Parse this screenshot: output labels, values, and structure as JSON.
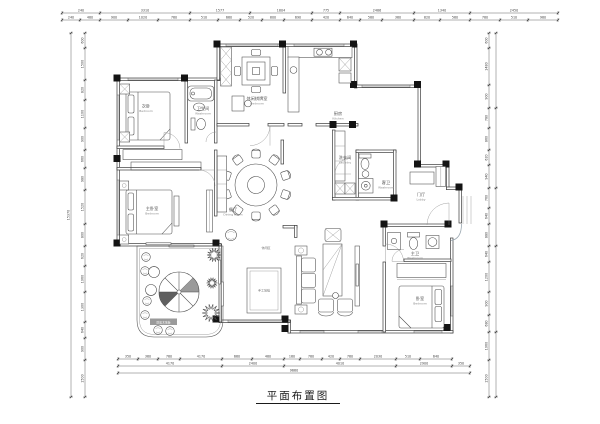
{
  "title": {
    "text": "平面布置图"
  },
  "rooms": {
    "bedroom2": {
      "zh": "次卧",
      "en": "Bedroom"
    },
    "bath1": {
      "zh": "卫生间",
      "en": "Washroom"
    },
    "leisure_room": {
      "zh": "休闲棋牌室",
      "en": "Bedroom"
    },
    "kitchen": {
      "zh": "厨房",
      "en": "Kitchen"
    },
    "laundry": {
      "zh": "洗衣间",
      "en": "Laundry"
    },
    "guest_bath": {
      "zh": "客卫",
      "en": "Washroom"
    },
    "lobby": {
      "zh": "门厅",
      "en": "Lobby"
    },
    "dining": {
      "zh": "餐厅",
      "en": "Dining Room"
    },
    "master_bedroom": {
      "zh": "主卧室",
      "en": "Bedroom"
    },
    "bedroom3": {
      "zh": "卧室",
      "en": "Bedroom"
    },
    "master_bath": {
      "zh": "主卫",
      "en": "Washroom"
    },
    "leisure_area": {
      "zh": "休闲区",
      "en": ""
    },
    "carpet_note": {
      "zh": "手工地毯",
      "en": ""
    },
    "deck_note": {
      "zh": "防腐木地板",
      "en": ""
    }
  },
  "dimensions": {
    "top_row1": [
      "240",
      "3310",
      "1577",
      "1804",
      "775",
      "2486",
      "1340",
      "2450"
    ],
    "top_row2": [
      "240",
      "480",
      "900",
      "1020",
      "760",
      "510",
      "660",
      "520",
      "800",
      "690",
      "420",
      "640",
      "580",
      "360",
      "820",
      "560",
      "780",
      "510",
      "980"
    ],
    "bottom_row1": [
      "350",
      "360",
      "760",
      "4170",
      "660",
      "480",
      "160",
      "780",
      "420",
      "760",
      "2030",
      "510",
      "640"
    ],
    "bottom_row2": [
      "4170",
      "2400",
      "4010",
      "2900",
      "350"
    ],
    "bottom_total": "9660",
    "left_rows": [
      "600",
      "1500",
      "820",
      "1100",
      "900",
      "660",
      "980",
      "1520",
      "800",
      "620",
      "1060",
      "1300",
      "640",
      "900",
      "1500"
    ],
    "left_total": "15370",
    "right_rows": [
      "600",
      "1480",
      "900",
      "780",
      "860",
      "620",
      "940",
      "760",
      "640",
      "880",
      "640",
      "1200",
      "900",
      "680",
      "1060",
      "1500"
    ]
  },
  "colors": {
    "wall": "#3b3b3b",
    "column": "#141414",
    "line": "#4a4a4a",
    "label": "#555555",
    "sublabel": "#8a8a8a",
    "dim_text": "#444444"
  }
}
